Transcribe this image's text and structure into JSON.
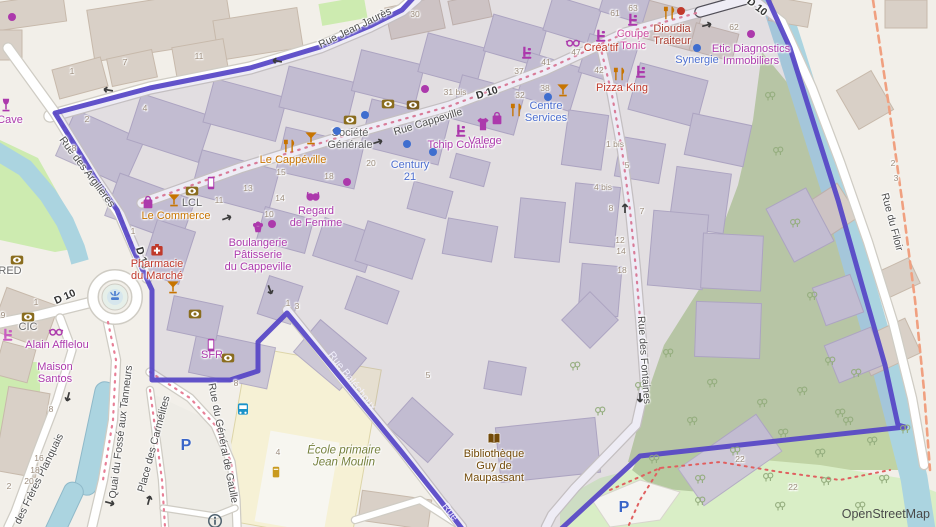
{
  "attribution": "OpenStreetMap",
  "colors": {
    "land": "#f2efe9",
    "water": "#abd4e0",
    "green": "#cdebb0",
    "scrub": "#c0d3a4",
    "park": "#d9eec6",
    "building_out": "#d9d0c7",
    "building_out_stroke": "#c7b9ab",
    "building_in": "#cdc8d6",
    "building_in_stroke": "#b4adc4",
    "road": "#ffffff",
    "casing": "#cfccc4",
    "school": "#f6f1d5",
    "boundary": "#5646c6",
    "inside_tint": "rgba(125,112,180,0.13)",
    "admin_dash": "#f0a080",
    "road_dots": "#e77f96",
    "footpath": "#e06060",
    "tree": "#94ad7e",
    "shop": "#ac39ac",
    "amenity": "#c77400",
    "office_blue": "#4d6fd0",
    "food_red": "#c0392b",
    "library_brown": "#734a08",
    "school_text": "#75803c",
    "bank_gold": "#8a6d1e",
    "parking_blue": "#3965c8"
  },
  "street_labels": [
    {
      "name": "rue-jean-jaures",
      "text": "Rue Jean Jaurès",
      "x": 355,
      "y": 28,
      "rot": -26
    },
    {
      "name": "rue-cappeville",
      "text": "Rue Cappeville",
      "x": 428,
      "y": 122,
      "rot": -17
    },
    {
      "name": "rue-des-argilieres",
      "text": "Rue des Argilières",
      "x": 87,
      "y": 172,
      "rot": 53
    },
    {
      "name": "rue-des-fontaines",
      "text": "Rue des Fontaines",
      "x": 644,
      "y": 360,
      "rot": 86
    },
    {
      "name": "rue-du-filoir",
      "text": "Rue du Filoir",
      "x": 892,
      "y": 222,
      "rot": 75
    },
    {
      "name": "rue-balechoux",
      "text": "Rue Baléchoux",
      "x": 352,
      "y": 381,
      "rot": 52,
      "white": true
    },
    {
      "name": "rue-balechoux-partial",
      "text": "Rue",
      "x": 450,
      "y": 512,
      "rot": 52,
      "white": true
    },
    {
      "name": "quai-du-fosse-aux-tanneurs",
      "text": "Quai du Fossé aux Tanneurs",
      "x": 121,
      "y": 432,
      "rot": -83
    },
    {
      "name": "place-des-carmelites",
      "text": "Place des Carmélites",
      "x": 154,
      "y": 444,
      "rot": -75
    },
    {
      "name": "rue-du-general-de-gaulle",
      "text": "Rue du Général de Gaulle",
      "x": 223,
      "y": 443,
      "rot": 79
    },
    {
      "name": "rue-des-freres-planquais",
      "text": "des Frères Planquais",
      "x": 39,
      "y": 479,
      "rot": -64
    }
  ],
  "road_refs": [
    {
      "text": "D 10",
      "x": 487,
      "y": 93,
      "rot": -17
    },
    {
      "text": "D 10",
      "x": 65,
      "y": 297,
      "rot": -24
    },
    {
      "text": "D 10",
      "x": 142,
      "y": 258,
      "rot": 73
    },
    {
      "text": "D 10",
      "x": 757,
      "y": 7,
      "rot": 38
    }
  ],
  "poi_labels": [
    {
      "name": "cave",
      "lines": [
        "Cave"
      ],
      "x": 10,
      "y": 121,
      "color": "#ac39ac"
    },
    {
      "name": "le-cappeville",
      "lines": [
        "Le Cappéville"
      ],
      "x": 293,
      "y": 161,
      "color": "#c77400"
    },
    {
      "name": "societe-generale",
      "lines": [
        "Société",
        "Générale"
      ],
      "x": 350,
      "y": 140,
      "color": "#606060"
    },
    {
      "name": "lcl",
      "lines": [
        "LCL"
      ],
      "x": 192,
      "y": 204,
      "color": "#606060"
    },
    {
      "name": "le-commerce",
      "lines": [
        "Le Commerce"
      ],
      "x": 176,
      "y": 217,
      "color": "#c77400"
    },
    {
      "name": "boulangerie-patisserie-du-cappeville",
      "lines": [
        "Boulangerie",
        "Pâtisserie",
        "du Cappeville"
      ],
      "x": 258,
      "y": 256,
      "color": "#ac39ac"
    },
    {
      "name": "regard-de-femme",
      "lines": [
        "Regard",
        "de Femme"
      ],
      "x": 316,
      "y": 218,
      "color": "#ac39ac"
    },
    {
      "name": "tchip-coiffure",
      "lines": [
        "Tchip Coiffure"
      ],
      "x": 461,
      "y": 146,
      "color": "#ac39ac"
    },
    {
      "name": "valege",
      "lines": [
        "Valege"
      ],
      "x": 485,
      "y": 142,
      "color": "#ac39ac"
    },
    {
      "name": "century-21",
      "lines": [
        "Century",
        "21"
      ],
      "x": 410,
      "y": 172,
      "color": "#4d6fd0"
    },
    {
      "name": "centre-services",
      "lines": [
        "Centre",
        "Services"
      ],
      "x": 546,
      "y": 113,
      "color": "#4d6fd0"
    },
    {
      "name": "creatif",
      "lines": [
        "Créa'tif"
      ],
      "x": 601,
      "y": 49,
      "color": "#c0392b"
    },
    {
      "name": "coupe-tonic",
      "lines": [
        "Coupe",
        "Tonic"
      ],
      "x": 633,
      "y": 41,
      "color": "#cb4a9f"
    },
    {
      "name": "dioudia-traiteur",
      "lines": [
        "Dioudia",
        "Traiteur"
      ],
      "x": 672,
      "y": 36,
      "color": "#a93a2e"
    },
    {
      "name": "etic-diagnostics-immobiliers",
      "lines": [
        "Etic Diagnostics",
        "Immobiliers"
      ],
      "x": 751,
      "y": 56,
      "color": "#ac39ac"
    },
    {
      "name": "synergie",
      "lines": [
        "Synergie"
      ],
      "x": 697,
      "y": 61,
      "color": "#4d6fd0"
    },
    {
      "name": "pizza-king",
      "lines": [
        "Pizza King"
      ],
      "x": 622,
      "y": 89,
      "color": "#c0392b"
    },
    {
      "name": "pharmacie-du-marche",
      "lines": [
        "Pharmacie",
        "du Marché"
      ],
      "x": 157,
      "y": 271,
      "color": "#c0392b"
    },
    {
      "name": "red",
      "lines": [
        "RED"
      ],
      "x": 10,
      "y": 272,
      "color": "#6a6a6a"
    },
    {
      "name": "cic",
      "lines": [
        "CIC"
      ],
      "x": 28,
      "y": 328,
      "color": "#6a6a6a"
    },
    {
      "name": "alain-afflelou",
      "lines": [
        "Alain Afflelou"
      ],
      "x": 57,
      "y": 346,
      "color": "#ac39ac"
    },
    {
      "name": "maison-santos",
      "lines": [
        "Maison",
        "Santos"
      ],
      "x": 55,
      "y": 374,
      "color": "#ac39ac"
    },
    {
      "name": "sfr",
      "lines": [
        "SFR"
      ],
      "x": 212,
      "y": 356,
      "color": "#ac39ac"
    },
    {
      "name": "ecole-primaire-jean-moulin",
      "lines": [
        "École primaire",
        "Jean Moulin"
      ],
      "x": 344,
      "y": 457,
      "color": "#75803c",
      "italic": true
    },
    {
      "name": "bibliotheque-guy-de-maupassant",
      "lines": [
        "Bibliothèque",
        "Guy de",
        "Maupassant"
      ],
      "x": 494,
      "y": 467,
      "color": "#734a08"
    }
  ],
  "house_numbers": [
    [
      72,
      71,
      "1"
    ],
    [
      125,
      62,
      "7"
    ],
    [
      199,
      56,
      "11"
    ],
    [
      87,
      119,
      "2"
    ],
    [
      145,
      108,
      "4"
    ],
    [
      74,
      148,
      "8"
    ],
    [
      415,
      14,
      "30"
    ],
    [
      455,
      92,
      "31 bis"
    ],
    [
      281,
      172,
      "15"
    ],
    [
      248,
      188,
      "13"
    ],
    [
      219,
      200,
      "11"
    ],
    [
      269,
      214,
      "10"
    ],
    [
      280,
      198,
      "14"
    ],
    [
      371,
      163,
      "20"
    ],
    [
      329,
      176,
      "18"
    ],
    [
      520,
      95,
      "32"
    ],
    [
      545,
      88,
      "38"
    ],
    [
      519,
      71,
      "37"
    ],
    [
      546,
      62,
      "41"
    ],
    [
      599,
      70,
      "42"
    ],
    [
      576,
      52,
      "47"
    ],
    [
      615,
      13,
      "61"
    ],
    [
      633,
      8,
      "63"
    ],
    [
      734,
      27,
      "62"
    ],
    [
      615,
      144,
      "1 bis"
    ],
    [
      627,
      165,
      "5"
    ],
    [
      893,
      163,
      "2"
    ],
    [
      896,
      178,
      "3"
    ],
    [
      603,
      187,
      "4 bis"
    ],
    [
      611,
      208,
      "8"
    ],
    [
      642,
      211,
      "7"
    ],
    [
      620,
      240,
      "12"
    ],
    [
      621,
      251,
      "14"
    ],
    [
      622,
      270,
      "18"
    ],
    [
      236,
      383,
      "8"
    ],
    [
      51,
      409,
      "8"
    ],
    [
      39,
      458,
      "16"
    ],
    [
      35,
      470,
      "18"
    ],
    [
      29,
      481,
      "20"
    ],
    [
      9,
      486,
      "2"
    ],
    [
      278,
      452,
      "4"
    ],
    [
      428,
      375,
      "5"
    ],
    [
      740,
      459,
      "22"
    ],
    [
      793,
      487,
      "22"
    ],
    [
      36,
      302,
      "1"
    ],
    [
      3,
      315,
      "9"
    ],
    [
      288,
      303,
      "1"
    ],
    [
      297,
      306,
      "3"
    ],
    [
      133,
      231,
      "1"
    ]
  ],
  "icons": [
    {
      "n": "bank",
      "x": 350,
      "y": 120,
      "c": "#8a6d1e"
    },
    {
      "n": "bank",
      "x": 192,
      "y": 191,
      "c": "#8a6d1e"
    },
    {
      "n": "bank",
      "x": 17,
      "y": 260,
      "c": "#8a6d1e"
    },
    {
      "n": "bank",
      "x": 28,
      "y": 317,
      "c": "#8a6d1e"
    },
    {
      "n": "bank",
      "x": 228,
      "y": 358,
      "c": "#8a6d1e"
    },
    {
      "n": "bank",
      "x": 195,
      "y": 314,
      "c": "#8a6d1e"
    },
    {
      "n": "bank",
      "x": 388,
      "y": 104,
      "c": "#8a6d1e"
    },
    {
      "n": "bank",
      "x": 413,
      "y": 105,
      "c": "#7a5c1e"
    },
    {
      "n": "cocktail",
      "x": 311,
      "y": 138,
      "c": "#c77400"
    },
    {
      "n": "cocktail",
      "x": 174,
      "y": 200,
      "c": "#c77400"
    },
    {
      "n": "cocktail",
      "x": 563,
      "y": 90,
      "c": "#c77400"
    },
    {
      "n": "cocktail",
      "x": 173,
      "y": 287,
      "c": "#c77400"
    },
    {
      "n": "wine-glass",
      "x": 6,
      "y": 105,
      "c": "#ac39ac"
    },
    {
      "n": "fork-knife",
      "x": 289,
      "y": 146,
      "c": "#c77400"
    },
    {
      "n": "fork-knife",
      "x": 516,
      "y": 110,
      "c": "#c77400"
    },
    {
      "n": "fork-knife",
      "x": 619,
      "y": 74,
      "c": "#c77400"
    },
    {
      "n": "fork-knife",
      "x": 669,
      "y": 13,
      "c": "#c77400"
    },
    {
      "n": "hairdresser",
      "x": 461,
      "y": 131,
      "c": "#ac39ac"
    },
    {
      "n": "hairdresser",
      "x": 601,
      "y": 36,
      "c": "#ac39ac"
    },
    {
      "n": "hairdresser",
      "x": 633,
      "y": 20,
      "c": "#ac39ac"
    },
    {
      "n": "hairdresser",
      "x": 527,
      "y": 53,
      "c": "#ac39ac"
    },
    {
      "n": "hairdresser",
      "x": 641,
      "y": 72,
      "c": "#ac39ac"
    },
    {
      "n": "hairdresser",
      "x": 8,
      "y": 335,
      "c": "#c95fc0"
    },
    {
      "n": "glasses",
      "x": 573,
      "y": 42,
      "c": "#ac39ac"
    },
    {
      "n": "glasses",
      "x": 56,
      "y": 331,
      "c": "#ac39ac"
    },
    {
      "n": "shirt",
      "x": 483,
      "y": 124,
      "c": "#ac39ac"
    },
    {
      "n": "bag",
      "x": 497,
      "y": 118,
      "c": "#ac39ac"
    },
    {
      "n": "bag",
      "x": 148,
      "y": 202,
      "c": "#ac39ac"
    },
    {
      "n": "phone",
      "x": 211,
      "y": 345,
      "c": "#ac39ac"
    },
    {
      "n": "phone",
      "x": 211,
      "y": 183,
      "c": "#ac39ac"
    },
    {
      "n": "first-aid",
      "x": 157,
      "y": 250,
      "c": "#c0392b"
    },
    {
      "n": "book",
      "x": 494,
      "y": 439,
      "c": "#734a08"
    },
    {
      "n": "bra",
      "x": 313,
      "y": 196,
      "c": "#ac39ac"
    },
    {
      "n": "cupcake",
      "x": 258,
      "y": 226,
      "c": "#ac39ac"
    },
    {
      "n": "bus",
      "x": 243,
      "y": 409,
      "c": "#1a93c9"
    },
    {
      "n": "info",
      "x": 215,
      "y": 521,
      "c": "#50626f"
    },
    {
      "n": "fountain",
      "x": 115,
      "y": 296,
      "c": "#4d7fd0"
    },
    {
      "n": "postbox",
      "x": 276,
      "y": 472,
      "c": "#c99a1e"
    }
  ],
  "parking_marks": [
    [
      186,
      446
    ],
    [
      624,
      508
    ]
  ],
  "dots": [
    {
      "x": 425,
      "y": 89,
      "c": "#ac39ac"
    },
    {
      "x": 347,
      "y": 182,
      "c": "#ac39ac"
    },
    {
      "x": 272,
      "y": 224,
      "c": "#ac39ac"
    },
    {
      "x": 751,
      "y": 34,
      "c": "#ac39ac"
    },
    {
      "x": 12,
      "y": 17,
      "c": "#ac39ac"
    },
    {
      "x": 365,
      "y": 115,
      "c": "#3f6ecf"
    },
    {
      "x": 407,
      "y": 144,
      "c": "#3f6ecf"
    },
    {
      "x": 433,
      "y": 152,
      "c": "#3f6ecf"
    },
    {
      "x": 548,
      "y": 97,
      "c": "#3f6ecf"
    },
    {
      "x": 697,
      "y": 48,
      "c": "#3f6ecf"
    },
    {
      "x": 337,
      "y": 131,
      "c": "#3f6ecf"
    },
    {
      "x": 681,
      "y": 11,
      "c": "#c0392b"
    }
  ]
}
